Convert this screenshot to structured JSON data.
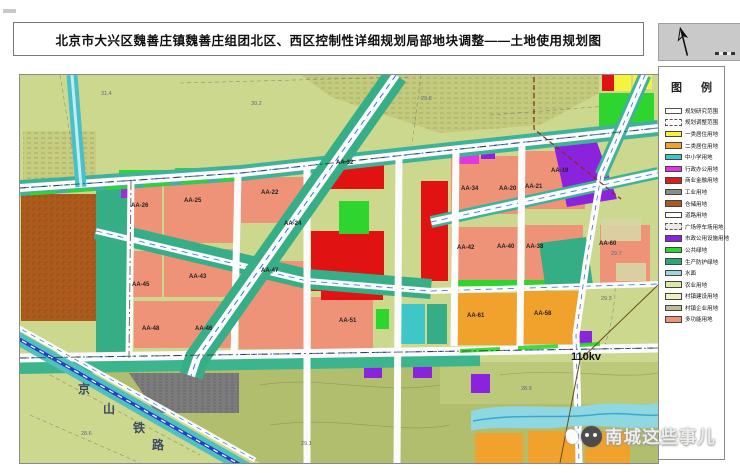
{
  "title": "北京市大兴区魏善庄镇魏善庄组团北区、西区控制性详细规划局部地块调整——土地使用规划图",
  "legend": {
    "title": "图 例",
    "items": [
      {
        "label": "规划研究范围",
        "color": "#ffffff",
        "border": "solid"
      },
      {
        "label": "规划调整范围",
        "color": "#ffffff",
        "border": "dashed"
      },
      {
        "label": "一类居住用地",
        "color": "#f6f23e",
        "border": "thin"
      },
      {
        "label": "二类居住用地",
        "color": "#f0a22c",
        "border": "thin"
      },
      {
        "label": "中小学用地",
        "color": "#3fc6c6",
        "border": "thin"
      },
      {
        "label": "行政办公用地",
        "color": "#e335e3",
        "border": "thin"
      },
      {
        "label": "商业金融用地",
        "color": "#d81f1c",
        "border": "thin"
      },
      {
        "label": "工业用地",
        "color": "#8c8c8c",
        "border": "thin"
      },
      {
        "label": "仓储用地",
        "color": "#a85a20",
        "border": "thin"
      },
      {
        "label": "道路用地",
        "color": "#ffffff",
        "border": "thin"
      },
      {
        "label": "广场停车场用地",
        "color": "#ecece4",
        "border": "dashed"
      },
      {
        "label": "市政公用设施用地",
        "color": "#8b22dd",
        "border": "thin"
      },
      {
        "label": "公共绿地",
        "color": "#2fd52f",
        "border": "thin"
      },
      {
        "label": "生产防护绿地",
        "color": "#2aa87c",
        "border": "thin"
      },
      {
        "label": "水面",
        "color": "#9fd4e4",
        "border": "thin"
      },
      {
        "label": "农业用地",
        "color": "#dce8a6",
        "border": "thin"
      },
      {
        "label": "村镇建设用地",
        "color": "#f0f0c0",
        "border": "thin"
      },
      {
        "label": "村镇企业用地",
        "color": "#b6c296",
        "border": "thin"
      },
      {
        "label": "多功能用地",
        "color": "#ee9378",
        "border": "thin"
      }
    ]
  },
  "map": {
    "block_labels": [
      "AA-26",
      "AA-25",
      "AA-22",
      "AA-24",
      "AA-34",
      "AA-20",
      "AA-21",
      "AA-19",
      "AA-45",
      "AA-43",
      "AA-47",
      "AA-42",
      "AA-40",
      "AA-38",
      "AA-60",
      "AA-48",
      "AA-46",
      "AA-51",
      "AA-61",
      "AA-58",
      "AA-32"
    ],
    "railway_label": [
      "京",
      "山",
      "铁",
      "路"
    ],
    "power_label": "110kv",
    "elevations": [
      "31.4",
      "30.2",
      "29.8",
      "29.7",
      "29.3",
      "28.6",
      "29.1",
      "28.9"
    ]
  },
  "watermark": {
    "text": "南城这些事儿"
  },
  "palette": {
    "agricultural": "#ccd88e",
    "village": "#c3ca7e",
    "village_bottom": "#b1be6e",
    "residential_multi": "#ee9378",
    "residential_r1": "#f6f23e",
    "residential_r2": "#f0a22c",
    "commercial": "#e01312",
    "industrial": "#7c7c7c",
    "warehouse": "#ad5b1d",
    "municipal": "#8b22dd",
    "admin_office": "#e335e3",
    "school": "#3fc6c6",
    "green_public": "#2fd52f",
    "green_protect": "#35ad85",
    "road_band": "#3fb39a",
    "railway_line": "#1f3fd0",
    "water": "#8fd8e2"
  }
}
